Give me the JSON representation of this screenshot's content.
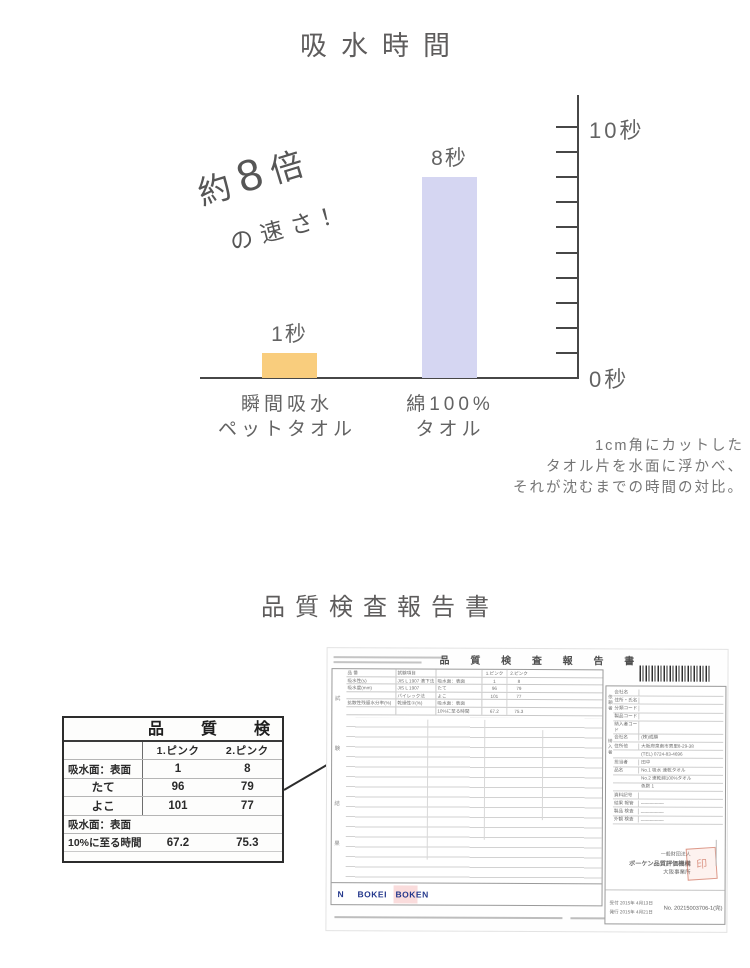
{
  "page": {
    "title": "吸水時間",
    "section2_title": "品質検査報告書"
  },
  "chart_data": {
    "type": "bar",
    "title": "吸水時間",
    "categories": [
      "瞬間吸水ペットタオル",
      "綿100%タオル"
    ],
    "category_lines": [
      [
        "瞬間吸水",
        "ペットタオル"
      ],
      [
        "綿100%",
        "タオル"
      ]
    ],
    "values": [
      1,
      8
    ],
    "bar_labels": [
      "1秒",
      "8秒"
    ],
    "bar_colors": [
      "#f9cd7d",
      "#d5d6f2"
    ],
    "unit": "秒",
    "ylim": [
      0,
      10
    ],
    "tick_count": 10,
    "y_axis_top_label": "10秒",
    "y_axis_bottom_label": "0秒",
    "legend_position": "none",
    "grid": false,
    "annotation": {
      "prefix": "約",
      "number": "8",
      "suffix": "倍",
      "line2": "の速さ！"
    },
    "caption_lines": [
      "1cm角にカットした",
      "タオル片を水面に浮かべ、",
      "それが沈むまでの時間の対比。"
    ]
  },
  "excerpt_table": {
    "header": "品質検",
    "col_headers": [
      "1.ピンク",
      "2.ピンク"
    ],
    "rows": [
      {
        "label": "吸水面：表面",
        "v1": "1",
        "v2": "8"
      },
      {
        "label": "たて",
        "v1": "96",
        "v2": "79"
      },
      {
        "label": "よこ",
        "v1": "101",
        "v2": "77"
      },
      {
        "label": "吸水面：表面",
        "v1": "",
        "v2": ""
      },
      {
        "label": "10%に至る時間",
        "v1": "67.2",
        "v2": "75.3"
      }
    ]
  },
  "report": {
    "doc_title": "品 質 検 査 報 告 書",
    "margin_labels": [
      "試",
      "験",
      "結",
      "果"
    ],
    "scan_table": {
      "rows": [
        {
          "a": "品 番",
          "b": "試験項目",
          "c": "",
          "d": "1.ピンク",
          "e": "2.ピンク"
        },
        {
          "a": "吸水性(s)",
          "b": "JIS L 1907 滴下法",
          "c": "吸水面：表面",
          "d": "1",
          "e": "8"
        },
        {
          "a": "吸水度(mm)",
          "b": "JIS L 1907",
          "c": "たて",
          "d": "96",
          "e": "79"
        },
        {
          "a": "",
          "b": "バイレック法",
          "c": "よこ",
          "d": "101",
          "e": "77"
        },
        {
          "a": "拡散性残留水分率(%)",
          "b": "乾燥性①(%)",
          "c": "吸水面：表面",
          "d": "",
          "e": ""
        },
        {
          "a": "",
          "b": "",
          "c": "10%に至る時間",
          "d": "67.2",
          "e": "75.3"
        }
      ]
    },
    "group_labels": [
      "依頼者",
      "納入者"
    ],
    "right_rows": [
      {
        "l": "会社名",
        "v": ""
      },
      {
        "l": "住所・氏名",
        "v": ""
      },
      {
        "l": "分類コード",
        "v": ""
      },
      {
        "l": "製品コード",
        "v": ""
      },
      {
        "l": "納入者コード",
        "v": ""
      },
      {
        "l": "会社名",
        "v": "(株)成願"
      },
      {
        "l": "住所他",
        "v": "大阪府泉南市男里8-29-38"
      },
      {
        "l": "",
        "v": "(TEL) 0724-83-4696"
      },
      {
        "l": "担当者",
        "v": "田中"
      },
      {
        "l": "品名",
        "v": "No.1 吸水 速乾タオル"
      },
      {
        "l": "",
        "v": "No.2 速乾綿100%タオル"
      },
      {
        "l": "",
        "v": "色数 1"
      },
      {
        "l": "資料記号",
        "v": ""
      },
      {
        "l": "結果 報管",
        "v": "―――――"
      },
      {
        "l": "製品 検査",
        "v": "―――――"
      },
      {
        "l": "外観 検査",
        "v": "―――――"
      }
    ],
    "logos": [
      "N",
      "BOKEI",
      "BOKEN"
    ],
    "org_lines": [
      "一般財団法人",
      "ボーケン品質評価機構",
      "大阪事業所"
    ],
    "seal_text": "印",
    "receipt_date": "受付 2015年 4月13日",
    "issue_date": "発行 2015年 4月21日",
    "report_no": "No. 20215003706-1(完)"
  }
}
